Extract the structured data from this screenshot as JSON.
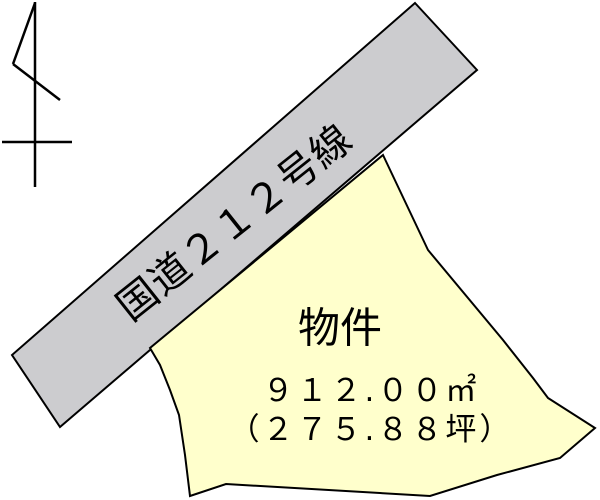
{
  "road": {
    "label": "国道２１２号線"
  },
  "parcel": {
    "label": "物件",
    "area_sqm": "９１２.００㎡",
    "area_tsubo": "（２７５.８８坪）"
  },
  "shapes": {
    "road_band_points": "415,3 477,70 60,427 12,355",
    "parcel_points": "383,155 428,250 503,340 533,378 548,398 595,428 560,458 497,475 430,496 226,484 190,496 185,455 179,415 170,390 160,365 150,348"
  },
  "colors": {
    "background": "#ffffff",
    "outline": "#000000",
    "text": "#000000",
    "road_fill": "#cccccf",
    "parcel_fill": "#ffffcc"
  },
  "icons": {
    "north_indicator": "north-mark"
  }
}
